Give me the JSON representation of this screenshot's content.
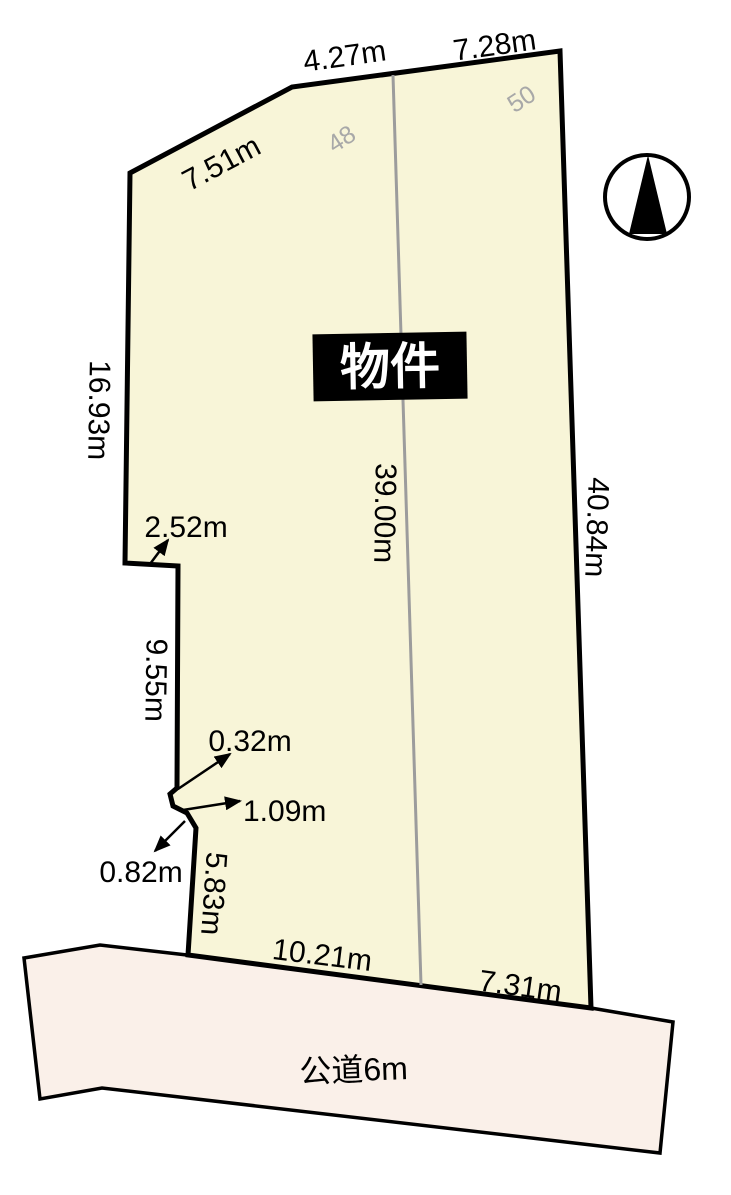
{
  "diagram": {
    "property_label": "物件",
    "road_label": "公道6m",
    "lot_numbers": {
      "left": "48",
      "right": "50"
    },
    "compass": {
      "icon": "north-arrow"
    },
    "dimensions": {
      "top_left_diagonal": "7.51m",
      "top_center": "4.27m",
      "top_right": "7.28m",
      "left_upper": "16.93m",
      "left_step": "2.52m",
      "left_mid": "9.55m",
      "jog_step_a": "0.32m",
      "jog_step_b": "1.09m",
      "jog_step_c": "0.82m",
      "left_lower": "5.83m",
      "bottom_left": "10.21m",
      "bottom_right": "7.31m",
      "center_line": "39.00m",
      "right_edge": "40.84m"
    },
    "colors": {
      "parcel_fill": "#f8f5d8",
      "road_fill": "#faf0e9",
      "divider_gray": "#9c9c9c",
      "lot_number_gray": "#a8a8a8",
      "outline_black": "#000000"
    }
  }
}
